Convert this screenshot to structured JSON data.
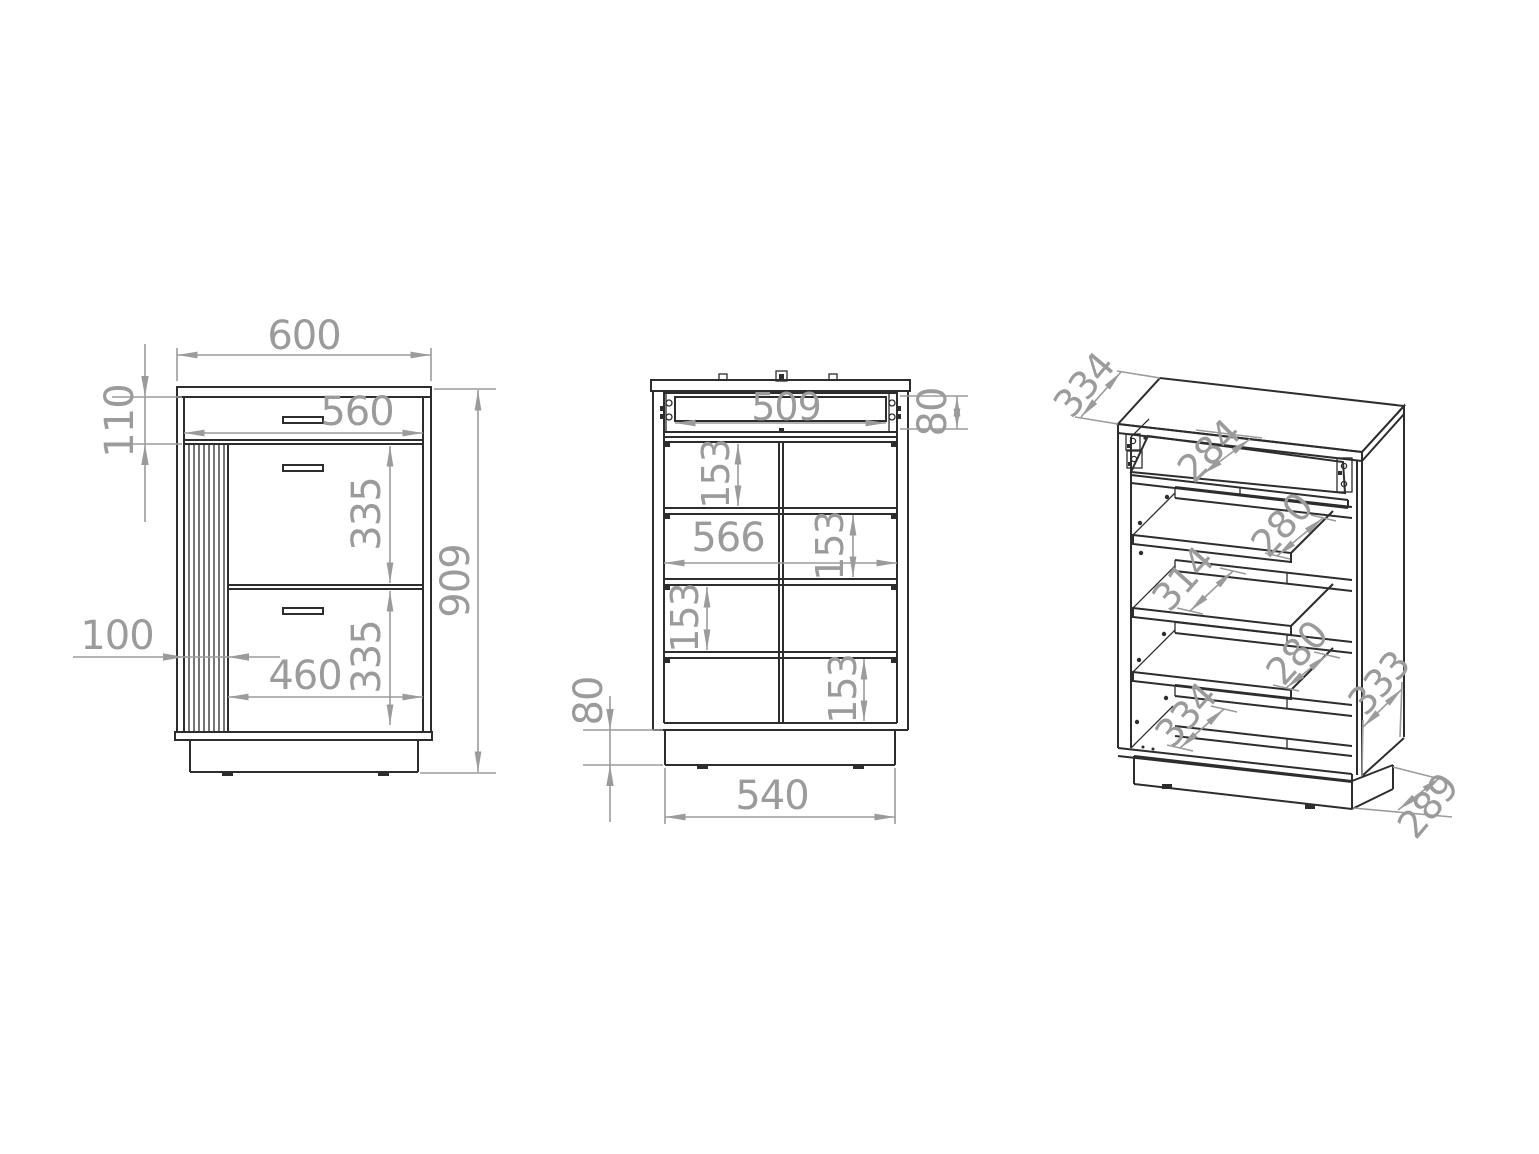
{
  "colors": {
    "background": "#ffffff",
    "object_line": "#2d2d2d",
    "dimension": "#9b9b9b"
  },
  "front": {
    "width": "600",
    "top_section_height": "110",
    "drawer_width": "560",
    "upper_door_height": "335",
    "lower_door_height": "335",
    "slat_panel_width": "100",
    "door_width": "460",
    "total_height": "909"
  },
  "internal": {
    "drawer_inner_width": "509",
    "drawer_box_height": "80",
    "section_height_1": "153",
    "inner_width": "566",
    "section_height_2": "153",
    "section_height_3": "153",
    "section_height_4": "153",
    "plinth_height": "80",
    "plinth_width": "540"
  },
  "isometric": {
    "top_depth": "334",
    "drawer_inner_depth": "284",
    "upper_shelf_depth": "280",
    "middle_shelf_depth": "314",
    "lower_shelf_depth": "280",
    "bottom_inner_depth": "334",
    "side_depth": "333",
    "plinth_depth": "289"
  }
}
